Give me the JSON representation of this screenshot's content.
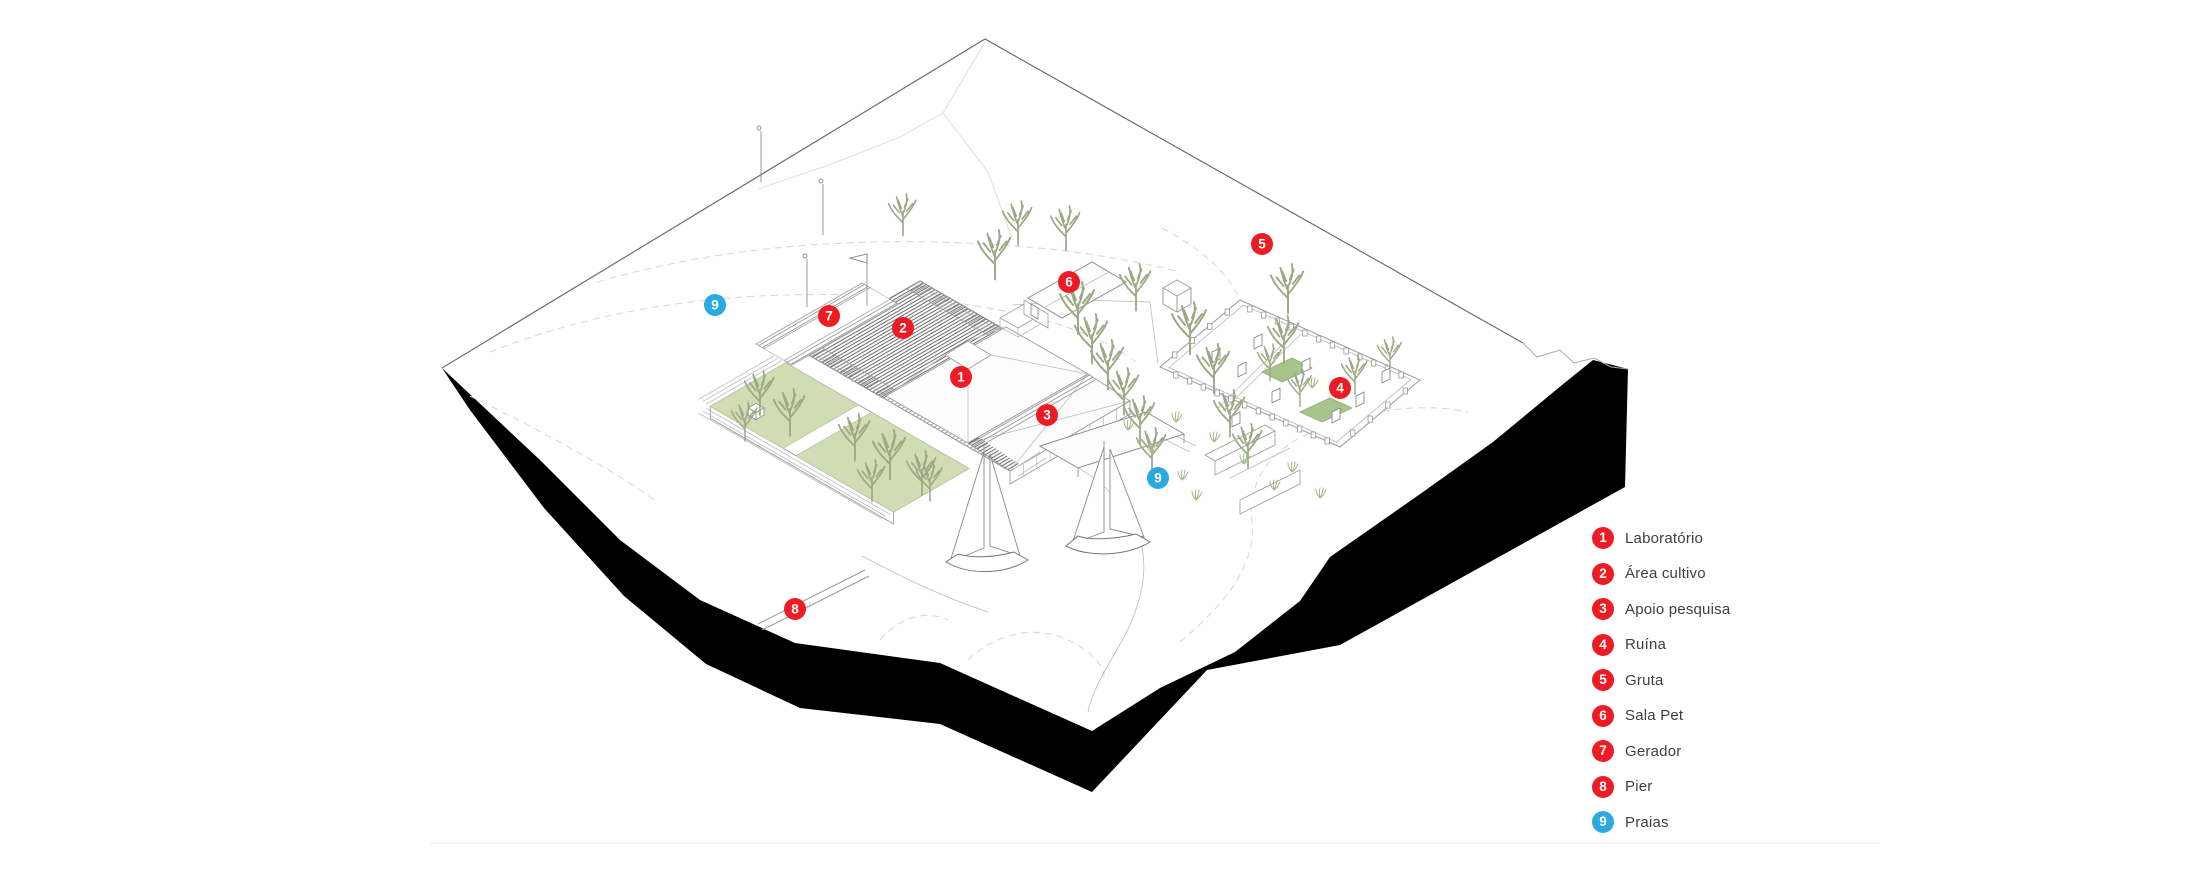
{
  "canvas": {
    "width": 2200,
    "height": 880,
    "background": "#FFFFFF"
  },
  "palette": {
    "marker_red": "#ED1C24",
    "marker_blue": "#29ABE2",
    "marker_number": "#FFFFFF",
    "legend_text": "#3E3E3E",
    "terrain_black": "#000000",
    "line_dark": "#6E6E6E",
    "line_faint": "#D8D8D8",
    "green_court": "#CFDCB4",
    "green_patch": "#A9C48B",
    "tree_line": "#9AA983",
    "hatch_line": "#8A8A8A"
  },
  "legend": {
    "items": [
      {
        "number": "1",
        "label": "Laboratório",
        "color": "red"
      },
      {
        "number": "2",
        "label": "Área cultivo",
        "color": "red"
      },
      {
        "number": "3",
        "label": "Apoio pesquisa",
        "color": "red"
      },
      {
        "number": "4",
        "label": "Ruína",
        "color": "red"
      },
      {
        "number": "5",
        "label": "Gruta",
        "color": "red"
      },
      {
        "number": "6",
        "label": "Sala Pet",
        "color": "red"
      },
      {
        "number": "7",
        "label": "Gerador",
        "color": "red"
      },
      {
        "number": "8",
        "label": "Pier",
        "color": "red"
      },
      {
        "number": "9",
        "label": "Praias",
        "color": "blue"
      }
    ]
  },
  "plan": {
    "markers": [
      {
        "number": "1",
        "x": 961,
        "y": 377,
        "color": "red"
      },
      {
        "number": "2",
        "x": 903,
        "y": 328,
        "color": "red"
      },
      {
        "number": "3",
        "x": 1047,
        "y": 415,
        "color": "red"
      },
      {
        "number": "4",
        "x": 1340,
        "y": 388,
        "color": "red"
      },
      {
        "number": "5",
        "x": 1262,
        "y": 244,
        "color": "red"
      },
      {
        "number": "6",
        "x": 1069,
        "y": 282,
        "color": "red"
      },
      {
        "number": "7",
        "x": 829,
        "y": 316,
        "color": "red"
      },
      {
        "number": "8",
        "x": 795,
        "y": 609,
        "color": "red"
      },
      {
        "number": "9",
        "x": 715,
        "y": 305,
        "color": "blue"
      },
      {
        "number": "9",
        "x": 1158,
        "y": 478,
        "color": "blue"
      }
    ]
  }
}
